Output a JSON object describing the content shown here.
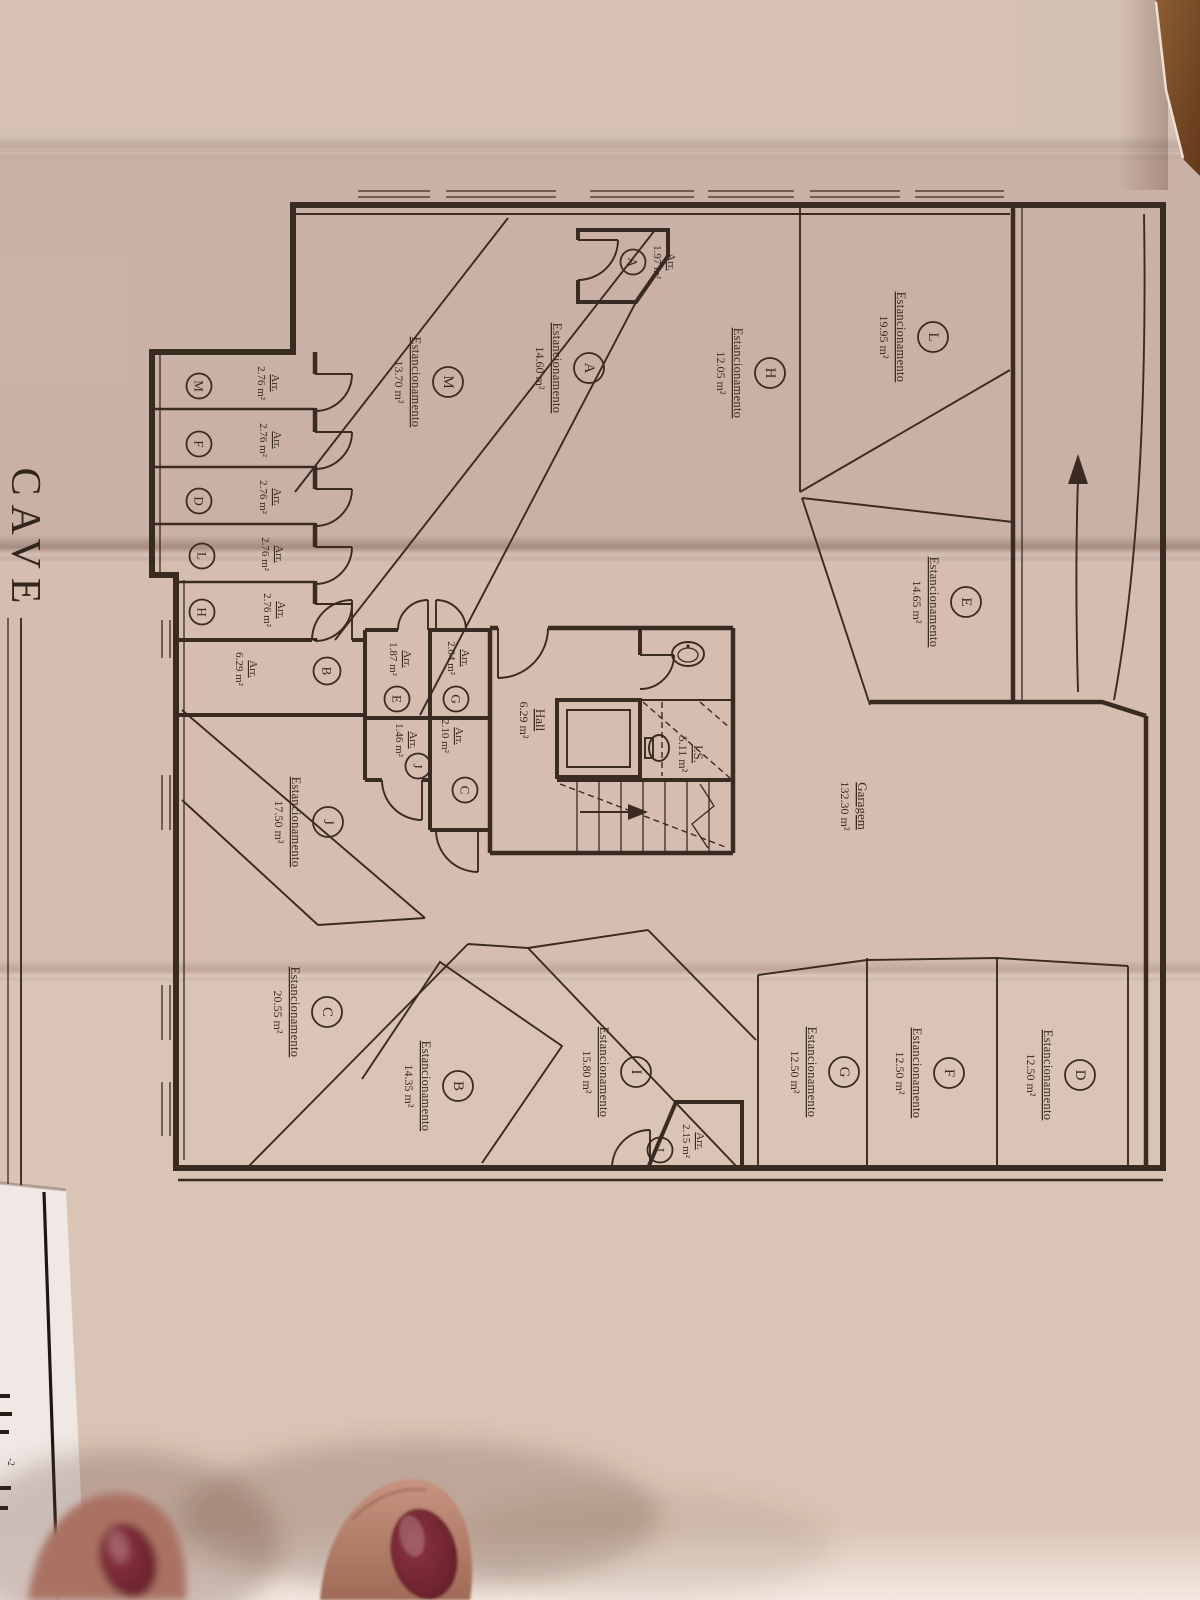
{
  "sheet": {
    "title": "CAVE",
    "floor_note": "-2",
    "parking_word": "Estancionamento",
    "storage_word": "Arr.",
    "garage": {
      "label": "Garagem",
      "area": "132.30 m²"
    },
    "hall": {
      "label": "Hall",
      "area": "6.29 m²"
    },
    "wc": {
      "label": "I.S.",
      "area": "5.11 m²"
    }
  },
  "colors": {
    "paper": "#d5bdb0",
    "ink": "#3a2b22",
    "wood": "#7c4c27",
    "nail": "#6f2330"
  },
  "parking_spaces": [
    {
      "letter": "L",
      "area": "19.95 m²"
    },
    {
      "letter": "A",
      "area": "14.60 m²"
    },
    {
      "letter": "H",
      "area": "12.05 m²"
    },
    {
      "letter": "M",
      "area": "13.70 m²"
    },
    {
      "letter": "E",
      "area": "14.65 m²"
    },
    {
      "letter": "J",
      "area": "17.50 m²"
    },
    {
      "letter": "C",
      "area": "20.55 m²"
    },
    {
      "letter": "B",
      "area": "14.35 m²"
    },
    {
      "letter": "I",
      "area": "15.80 m²"
    },
    {
      "letter": "G",
      "area": "12.50 m²"
    },
    {
      "letter": "F",
      "area": "12.50 m²"
    },
    {
      "letter": "D",
      "area": "12.50 m²"
    }
  ],
  "storage_rooms": [
    {
      "letter": "A",
      "area": "1.97 m²"
    },
    {
      "letter": "M",
      "area": "2.76 m²"
    },
    {
      "letter": "F",
      "area": "2.76 m²"
    },
    {
      "letter": "D",
      "area": "2.76 m²"
    },
    {
      "letter": "L",
      "area": "2.76 m²"
    },
    {
      "letter": "H",
      "area": "2.76 m²"
    },
    {
      "letter": "B",
      "area": "6.29 m²"
    },
    {
      "letter": "E",
      "area": "1.87 m²"
    },
    {
      "letter": "G",
      "area": "2.04 m²"
    },
    {
      "letter": "J",
      "area": "1.46 m²"
    },
    {
      "letter": "C",
      "area": "2.10 m²"
    },
    {
      "letter": "I",
      "area": "2.15 m²"
    }
  ]
}
